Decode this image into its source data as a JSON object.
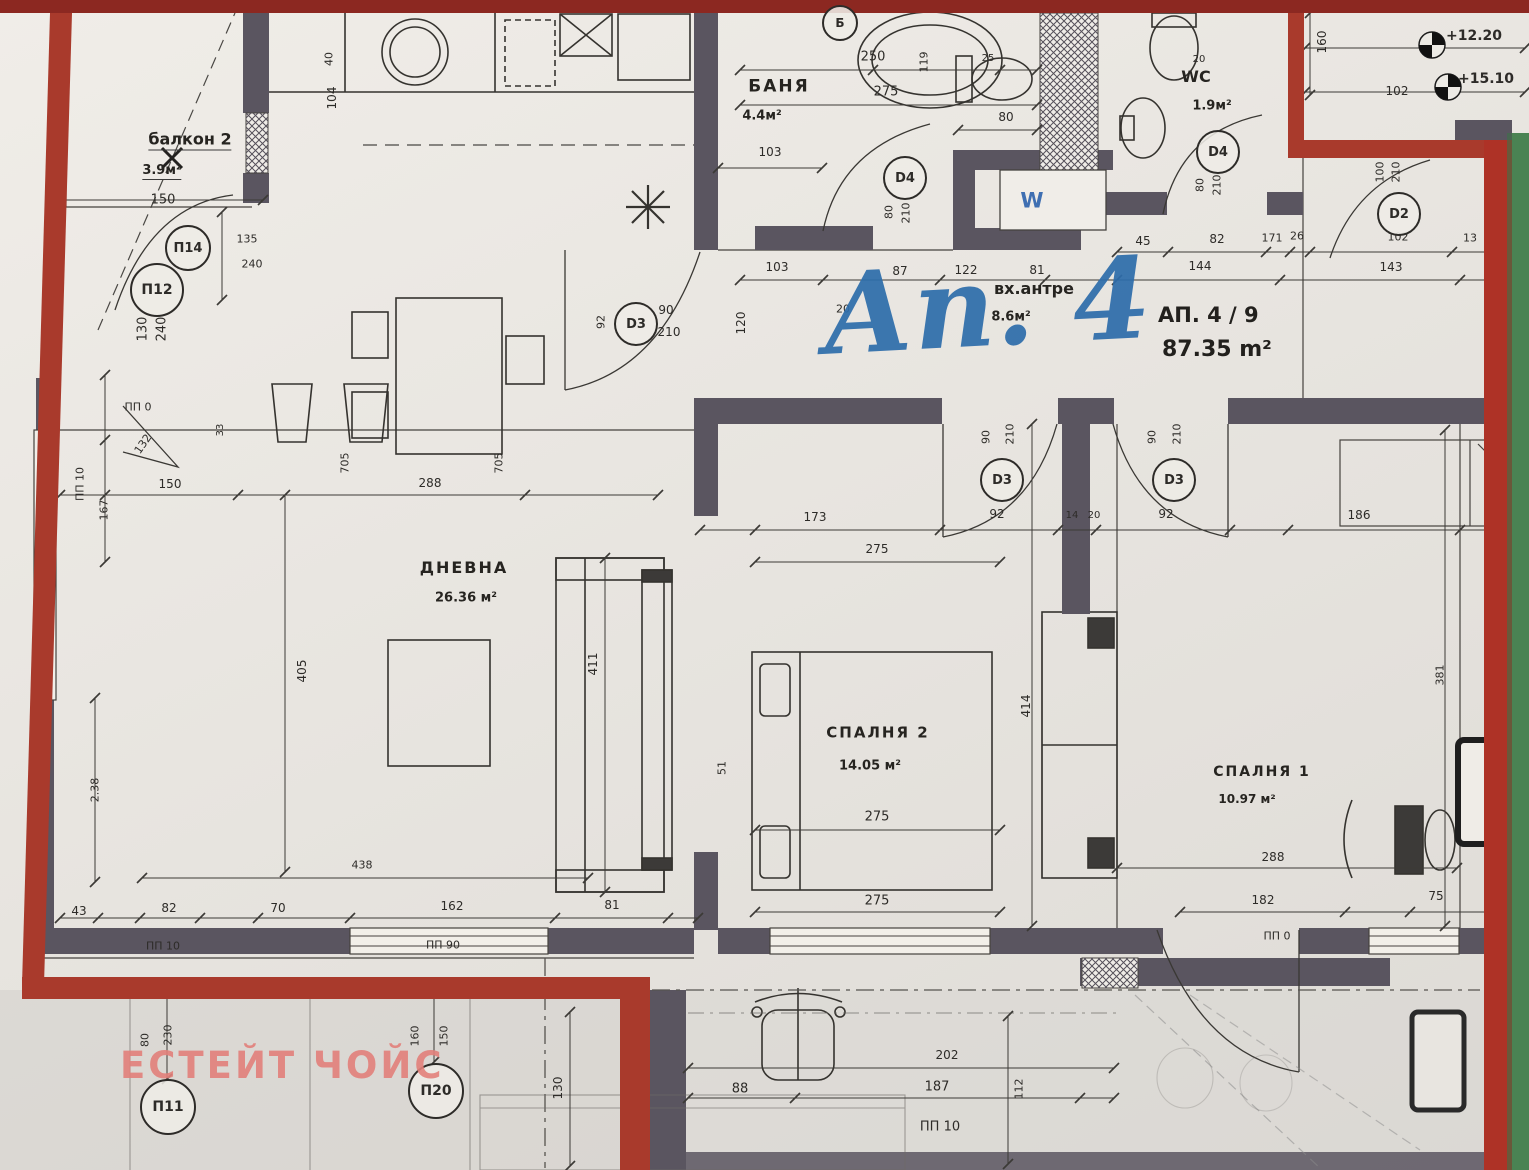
{
  "meta": {
    "title_script": "Ап. 4",
    "apartment_no": "АП. 4 / 9",
    "total_area": "87.35 m²",
    "watermark": "ЕСТЕЙТ ЧОЙС"
  },
  "colors": {
    "boundary_red": "#a93a2c",
    "top_border_red": "#8c2821",
    "right_strip_red": "#ae3226",
    "strip_green": "#4a8353",
    "wall_gray": "#5a5560",
    "title_blue": "#2e6dab",
    "watermark_pink": "#e2807a",
    "paper": "#e8e5e0"
  },
  "rooms": [
    {
      "name": "балкон 2",
      "area": "3.9м²"
    },
    {
      "name": "БАНЯ",
      "area": "4.4м²"
    },
    {
      "name": "WC",
      "area": "1.9м²"
    },
    {
      "name": "вх.антре",
      "area": "8.6м²"
    },
    {
      "name": "ДНЕВНА",
      "area": "26.36 м²"
    },
    {
      "name": "СПАЛНЯ 2",
      "area": "14.05 м²"
    },
    {
      "name": "СПАЛНЯ 1",
      "area": "10.97 м²"
    }
  ],
  "labels": [
    {
      "n": "room-balcony-label",
      "t": "балкон 2",
      "x": 190,
      "y": 141,
      "s": 16,
      "c": "room u"
    },
    {
      "n": "room-balcony-area",
      "t": "3.9м²",
      "x": 162,
      "y": 172,
      "s": 13,
      "c": "room u"
    },
    {
      "n": "room-bath-label",
      "t": "БАНЯ",
      "x": 779,
      "y": 87,
      "s": 17,
      "c": "room sp"
    },
    {
      "n": "room-bath-area",
      "t": "4.4м²",
      "x": 762,
      "y": 116,
      "s": 13,
      "c": "room"
    },
    {
      "n": "room-wc-label",
      "t": "WC",
      "x": 1196,
      "y": 77,
      "s": 16,
      "c": "room"
    },
    {
      "n": "room-wc-area",
      "t": "1.9м²",
      "x": 1212,
      "y": 106,
      "s": 13,
      "c": "room"
    },
    {
      "n": "room-hall-label",
      "t": "вх.антре",
      "x": 1034,
      "y": 289,
      "s": 16,
      "c": "room"
    },
    {
      "n": "room-hall-area",
      "t": "8.6м²",
      "x": 1011,
      "y": 317,
      "s": 13,
      "c": "room"
    },
    {
      "n": "room-living-label",
      "t": "ДНЕВНА",
      "x": 464,
      "y": 568,
      "s": 16,
      "c": "room sp"
    },
    {
      "n": "room-living-area",
      "t": "26.36 м²",
      "x": 466,
      "y": 598,
      "s": 13,
      "c": "room"
    },
    {
      "n": "room-bedroom2-label",
      "t": "СПАЛНЯ 2",
      "x": 878,
      "y": 733,
      "s": 15,
      "c": "room sp"
    },
    {
      "n": "room-bedroom2-area",
      "t": "14.05 м²",
      "x": 870,
      "y": 766,
      "s": 13,
      "c": "room"
    },
    {
      "n": "room-bedroom1-label",
      "t": "СПАЛНЯ 1",
      "x": 1262,
      "y": 772,
      "s": 14,
      "c": "room sp"
    },
    {
      "n": "room-bedroom1-area",
      "t": "10.97 м²",
      "x": 1247,
      "y": 799,
      "s": 12,
      "c": "room"
    },
    {
      "n": "elevation-mark-1",
      "t": "+12.20",
      "x": 1474,
      "y": 36,
      "s": 14,
      "c": "b"
    },
    {
      "n": "elevation-mark-2",
      "t": "+15.10",
      "x": 1486,
      "y": 79,
      "s": 14,
      "c": "b"
    },
    {
      "n": "washing-machine-label",
      "t": "W",
      "x": 1032,
      "y": 201,
      "s": 21,
      "c": "blue b"
    },
    {
      "t": "150",
      "x": 163,
      "y": 200
    },
    {
      "t": "135",
      "x": 247,
      "y": 239,
      "s": 11
    },
    {
      "t": "240",
      "x": 252,
      "y": 264,
      "s": 11
    },
    {
      "t": "130",
      "x": 143,
      "y": 329,
      "r": -90
    },
    {
      "t": "240",
      "x": 162,
      "y": 329,
      "r": -90
    },
    {
      "t": "40",
      "x": 329,
      "y": 59,
      "r": -90,
      "s": 11
    },
    {
      "t": "104",
      "x": 332,
      "y": 98,
      "r": -90,
      "s": 12
    },
    {
      "t": "250",
      "x": 873,
      "y": 57
    },
    {
      "t": "119",
      "x": 924,
      "y": 62,
      "r": -90,
      "s": 11
    },
    {
      "t": "275",
      "x": 886,
      "y": 92
    },
    {
      "t": "103",
      "x": 770,
      "y": 152,
      "s": 12
    },
    {
      "t": "80",
      "x": 1006,
      "y": 117,
      "s": 12
    },
    {
      "t": "25",
      "x": 988,
      "y": 59,
      "s": 10
    },
    {
      "t": "20",
      "x": 1199,
      "y": 60,
      "s": 10
    },
    {
      "t": "103",
      "x": 777,
      "y": 267,
      "s": 12
    },
    {
      "t": "87",
      "x": 900,
      "y": 271,
      "s": 12
    },
    {
      "t": "122",
      "x": 966,
      "y": 270,
      "s": 12
    },
    {
      "t": "81",
      "x": 1037,
      "y": 270,
      "s": 12
    },
    {
      "t": "45",
      "x": 1143,
      "y": 241,
      "s": 12
    },
    {
      "t": "82",
      "x": 1217,
      "y": 239,
      "s": 12
    },
    {
      "t": "171",
      "x": 1272,
      "y": 238,
      "s": 11
    },
    {
      "t": "26",
      "x": 1297,
      "y": 236,
      "s": 11
    },
    {
      "t": "144",
      "x": 1200,
      "y": 266,
      "s": 12
    },
    {
      "t": "143",
      "x": 1391,
      "y": 267,
      "s": 12
    },
    {
      "t": "13",
      "x": 1470,
      "y": 238,
      "s": 11
    },
    {
      "t": "160",
      "x": 1322,
      "y": 42,
      "r": -90,
      "s": 12
    },
    {
      "t": "102",
      "x": 1397,
      "y": 91,
      "s": 12
    },
    {
      "t": "102",
      "x": 1398,
      "y": 237,
      "s": 11
    },
    {
      "t": "100",
      "x": 1380,
      "y": 172,
      "r": -90,
      "s": 11
    },
    {
      "t": "210",
      "x": 1396,
      "y": 172,
      "r": -90,
      "s": 11
    },
    {
      "t": "80",
      "x": 889,
      "y": 212,
      "r": -90,
      "s": 11
    },
    {
      "t": "210",
      "x": 906,
      "y": 213,
      "r": -90,
      "s": 11
    },
    {
      "t": "80",
      "x": 1200,
      "y": 185,
      "r": -90,
      "s": 11
    },
    {
      "t": "210",
      "x": 1217,
      "y": 185,
      "r": -90,
      "s": 11
    },
    {
      "t": "90",
      "x": 666,
      "y": 310,
      "s": 12
    },
    {
      "t": "210",
      "x": 669,
      "y": 332,
      "s": 12
    },
    {
      "t": "92",
      "x": 601,
      "y": 322,
      "r": -90,
      "s": 11
    },
    {
      "t": "120",
      "x": 741,
      "y": 323,
      "r": -90,
      "s": 12
    },
    {
      "t": "20",
      "x": 843,
      "y": 309,
      "s": 11
    },
    {
      "t": "90",
      "x": 986,
      "y": 437,
      "r": -90,
      "s": 11
    },
    {
      "t": "210",
      "x": 1010,
      "y": 434,
      "r": -90,
      "s": 11
    },
    {
      "t": "90",
      "x": 1152,
      "y": 437,
      "r": -90,
      "s": 11
    },
    {
      "t": "210",
      "x": 1177,
      "y": 434,
      "r": -90,
      "s": 11
    },
    {
      "t": "92",
      "x": 997,
      "y": 514,
      "s": 12
    },
    {
      "t": "14",
      "x": 1072,
      "y": 516,
      "s": 10
    },
    {
      "t": "20",
      "x": 1094,
      "y": 516,
      "s": 10
    },
    {
      "t": "92",
      "x": 1166,
      "y": 514,
      "s": 12
    },
    {
      "t": "173",
      "x": 815,
      "y": 517,
      "s": 12
    },
    {
      "t": "186",
      "x": 1359,
      "y": 515,
      "s": 12
    },
    {
      "t": "275",
      "x": 877,
      "y": 549,
      "s": 12
    },
    {
      "t": "414",
      "x": 1026,
      "y": 706,
      "r": -90,
      "s": 12
    },
    {
      "t": "51",
      "x": 722,
      "y": 768,
      "r": -90,
      "s": 11
    },
    {
      "t": "275",
      "x": 877,
      "y": 817,
      "s": 13
    },
    {
      "t": "275",
      "x": 877,
      "y": 901,
      "s": 13
    },
    {
      "t": "411",
      "x": 593,
      "y": 664,
      "r": -90,
      "s": 12
    },
    {
      "t": "405",
      "x": 302,
      "y": 671,
      "r": -90,
      "s": 12
    },
    {
      "t": "2.38",
      "x": 95,
      "y": 790,
      "r": -90,
      "s": 11
    },
    {
      "t": "167",
      "x": 104,
      "y": 510,
      "r": -90,
      "s": 11
    },
    {
      "t": "ПП 10",
      "x": 80,
      "y": 484,
      "r": -90,
      "s": 11
    },
    {
      "t": "150",
      "x": 170,
      "y": 484,
      "s": 12
    },
    {
      "t": "288",
      "x": 430,
      "y": 483,
      "s": 12
    },
    {
      "t": "705",
      "x": 345,
      "y": 463,
      "r": -90,
      "s": 11
    },
    {
      "t": "705",
      "x": 499,
      "y": 463,
      "r": -90,
      "s": 11
    },
    {
      "t": "ПП 0",
      "x": 138,
      "y": 407,
      "s": 11
    },
    {
      "t": "132",
      "x": 143,
      "y": 444,
      "r": -55,
      "s": 11
    },
    {
      "t": "33",
      "x": 221,
      "y": 430,
      "r": -90,
      "s": 10
    },
    {
      "t": "438",
      "x": 362,
      "y": 865,
      "s": 11
    },
    {
      "t": "43",
      "x": 79,
      "y": 911,
      "s": 12
    },
    {
      "t": "82",
      "x": 169,
      "y": 908,
      "s": 12
    },
    {
      "t": "70",
      "x": 278,
      "y": 908,
      "s": 12
    },
    {
      "t": "162",
      "x": 452,
      "y": 906,
      "s": 12
    },
    {
      "t": "81",
      "x": 612,
      "y": 905,
      "s": 12
    },
    {
      "t": "ПП 10",
      "x": 163,
      "y": 946,
      "s": 11
    },
    {
      "t": "ПП 90",
      "x": 443,
      "y": 945,
      "s": 11
    },
    {
      "t": "88",
      "x": 740,
      "y": 1089,
      "s": 13
    },
    {
      "t": "187",
      "x": 937,
      "y": 1087,
      "s": 13
    },
    {
      "t": "202",
      "x": 947,
      "y": 1055,
      "s": 12
    },
    {
      "t": "ПП 10",
      "x": 940,
      "y": 1127,
      "s": 13
    },
    {
      "t": "112",
      "x": 1019,
      "y": 1089,
      "r": -90,
      "s": 11
    },
    {
      "t": "182",
      "x": 1263,
      "y": 900,
      "s": 12
    },
    {
      "t": "75",
      "x": 1436,
      "y": 896,
      "s": 12
    },
    {
      "t": "288",
      "x": 1273,
      "y": 857,
      "s": 12
    },
    {
      "t": "ПП 0",
      "x": 1277,
      "y": 936,
      "s": 11
    },
    {
      "t": "381",
      "x": 1440,
      "y": 675,
      "r": -90,
      "s": 11
    },
    {
      "t": "130",
      "x": 558,
      "y": 1088,
      "r": -90,
      "s": 12
    },
    {
      "t": "80",
      "x": 145,
      "y": 1040,
      "r": -90,
      "s": 11
    },
    {
      "t": "230",
      "x": 168,
      "y": 1035,
      "r": -90,
      "s": 11
    },
    {
      "t": "160",
      "x": 415,
      "y": 1036,
      "r": -90,
      "s": 11
    },
    {
      "t": "150",
      "x": 444,
      "y": 1036,
      "r": -90,
      "s": 11
    }
  ],
  "door_tags": [
    {
      "t": "П14",
      "x": 186,
      "y": 246,
      "d": 42
    },
    {
      "t": "П12",
      "x": 155,
      "y": 288,
      "d": 50
    },
    {
      "t": "D3",
      "x": 634,
      "y": 322,
      "d": 40
    },
    {
      "t": "D4",
      "x": 903,
      "y": 176,
      "d": 40
    },
    {
      "t": "D4",
      "x": 1216,
      "y": 150,
      "d": 40
    },
    {
      "t": "D2",
      "x": 1397,
      "y": 212,
      "d": 40
    },
    {
      "t": "D3",
      "x": 1000,
      "y": 478,
      "d": 40
    },
    {
      "t": "D3",
      "x": 1172,
      "y": 478,
      "d": 40
    },
    {
      "t": "Б",
      "x": 838,
      "y": 21,
      "d": 32
    },
    {
      "t": "П11",
      "x": 166,
      "y": 1105,
      "d": 52
    },
    {
      "t": "П20",
      "x": 434,
      "y": 1089,
      "d": 52
    }
  ]
}
